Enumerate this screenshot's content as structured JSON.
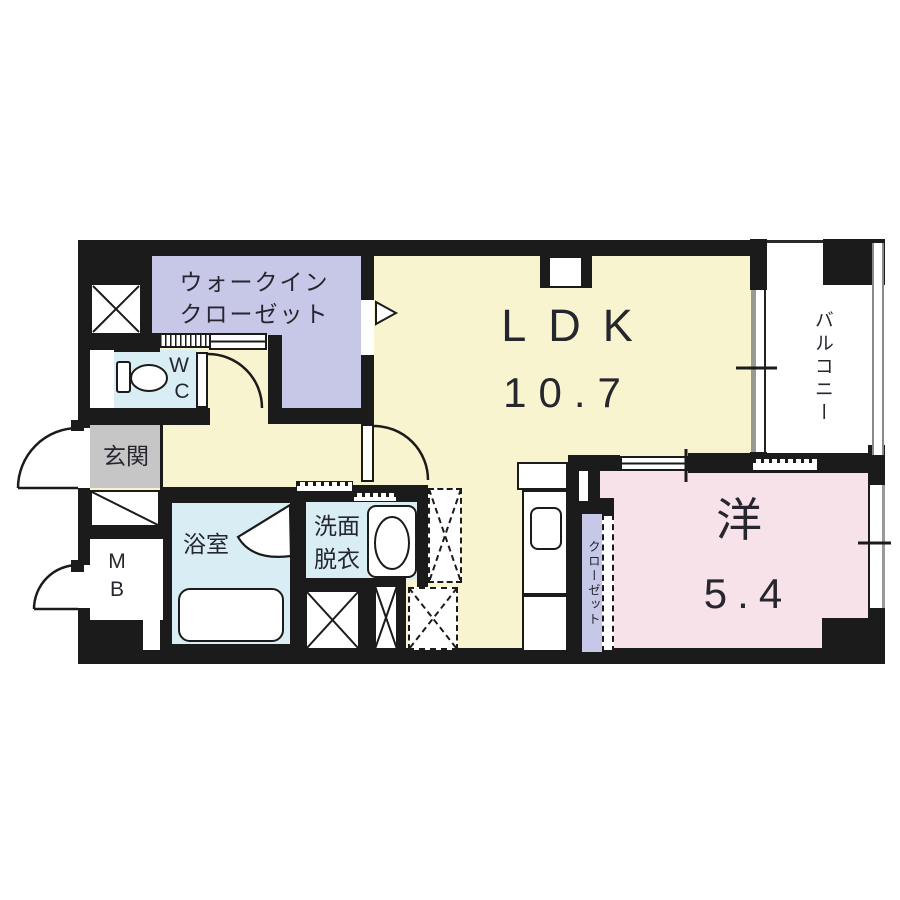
{
  "plan_type": "apartment-floor-plan",
  "rooms": {
    "walk_in_closet": {
      "label_line1": "ウォークイン",
      "label_line2": "クローゼット"
    },
    "ldk": {
      "name": "LDK",
      "area": "10.7"
    },
    "balcony": {
      "label": "バルコニー"
    },
    "toilet": {
      "label_line1": "W",
      "label_line2": "C"
    },
    "entrance": {
      "label": "玄関"
    },
    "meter_box": {
      "label_line1": "M",
      "label_line2": "B"
    },
    "bathroom": {
      "label": "浴室"
    },
    "washroom": {
      "label_line1": "洗面",
      "label_line2": "脱衣"
    },
    "western_room": {
      "name": "洋",
      "area": "5.4"
    },
    "closet": {
      "label": "クローゼット"
    }
  },
  "colors": {
    "wall": "#1b1b1b",
    "ldk_floor": "#f8f4cf",
    "closet_floor": "#c7c7e8",
    "wet_area_floor": "#d9edf4",
    "bedroom_floor": "#f8e2ea",
    "entrance_floor": "#c6c6c6",
    "balcony_floor": "#ffffff",
    "text": "#26262e"
  }
}
